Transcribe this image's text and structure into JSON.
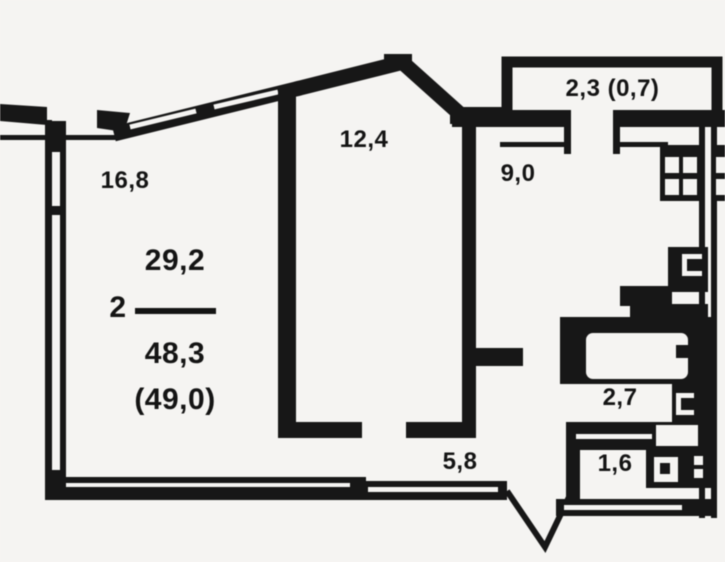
{
  "figure": {
    "type": "apartment-floor-plan",
    "units": "m2",
    "colors": {
      "background": "#f5f4f2",
      "walls": "#171717",
      "text": "#141414"
    },
    "summary": {
      "rooms_count": "2",
      "living_area": "29,2",
      "total_area": "48,3",
      "total_area_with_balcony": "(49,0)"
    },
    "rooms": [
      {
        "name": "living-room-1",
        "area": "16,8"
      },
      {
        "name": "living-room-2",
        "area": "12,4"
      },
      {
        "name": "kitchen",
        "area": "9,0"
      },
      {
        "name": "balcony",
        "area": "2,3 (0,7)"
      },
      {
        "name": "hallway",
        "area": "5,8"
      },
      {
        "name": "bathroom",
        "area": "2,7"
      },
      {
        "name": "wc",
        "area": "1,6"
      }
    ],
    "icons": [
      "stove-icon",
      "bathtub-icon",
      "tap-icon",
      "sink-icon",
      "riser-icon",
      "entry-door-icon"
    ]
  }
}
